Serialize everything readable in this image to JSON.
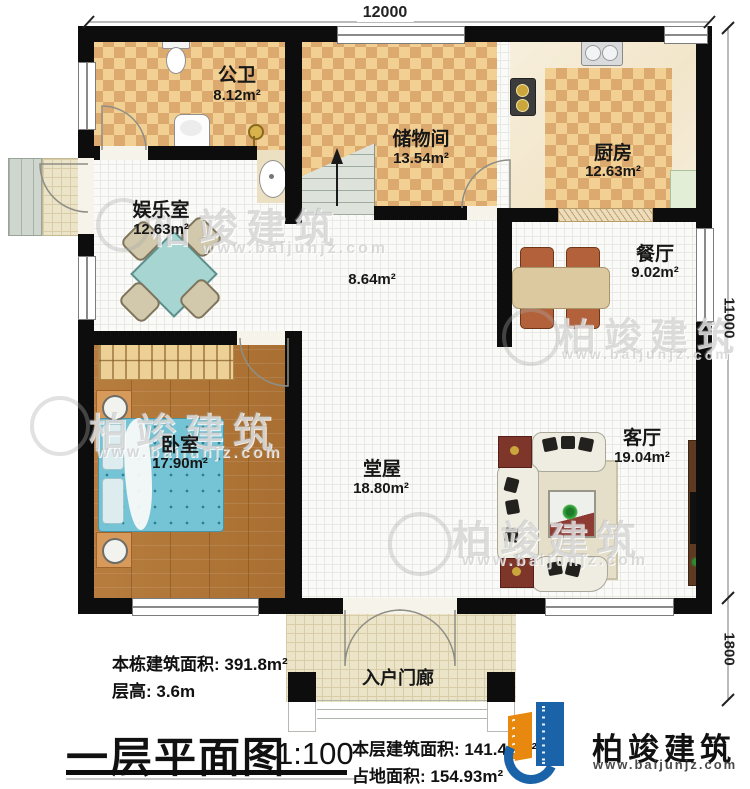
{
  "plan": {
    "title": "一层平面图",
    "scale": "1:100"
  },
  "dimensions": {
    "top_width": "12000",
    "right_height": "11000",
    "porch_depth": "1800"
  },
  "rooms": {
    "bathroom": {
      "name": "公卫",
      "area": "8.12m²"
    },
    "storage": {
      "name": "储物间",
      "area": "13.54m²"
    },
    "kitchen": {
      "name": "厨房",
      "area": "12.63m²"
    },
    "entertainment": {
      "name": "娱乐室",
      "area": "12.63m²"
    },
    "hallway": {
      "area": "8.64m²"
    },
    "dining": {
      "name": "餐厅",
      "area": "9.02m²"
    },
    "bedroom": {
      "name": "卧室",
      "area": "17.90m²"
    },
    "main_hall": {
      "name": "堂屋",
      "area": "18.80m²"
    },
    "living": {
      "name": "客厅",
      "area": "19.04m²"
    },
    "porch": {
      "name": "入户门廊"
    }
  },
  "stats": {
    "building_area": "本栋建筑面积: 391.8m²",
    "floor_height": "层高: 3.6m",
    "floor_area": "本层建筑面积: 141.40m²",
    "footprint_area": "占地面积: 154.93m²"
  },
  "brand": {
    "name": "柏竣建筑",
    "website": "www.baijunjz.com"
  },
  "colors": {
    "wall": "#0d0d0d",
    "checker_light": "#f2cf92",
    "checker_dark": "#dca96e",
    "wood": "#b1783a",
    "brand_blue": "#1b63a8",
    "brand_orange": "#e8880f"
  }
}
